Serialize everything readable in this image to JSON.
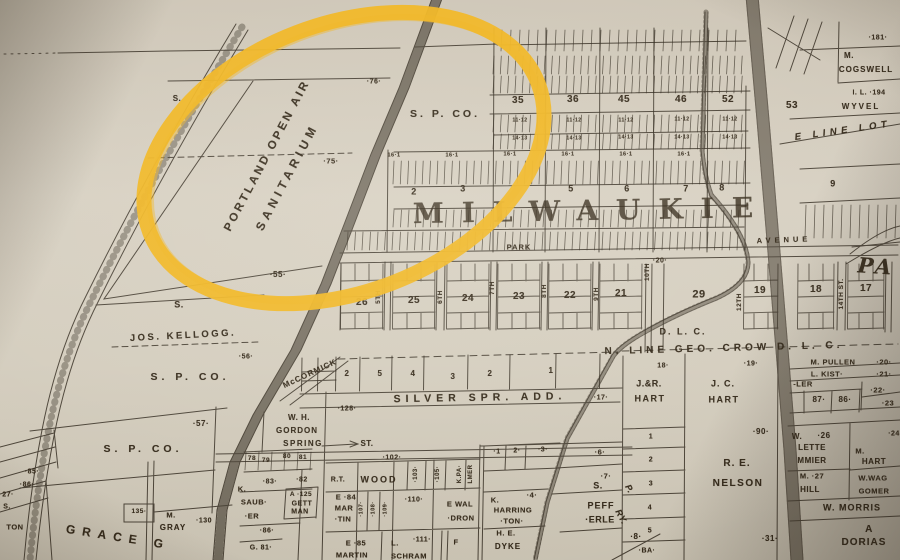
{
  "map": {
    "description": "Historic plat map of Milwaukie — Portland Open Air Sanitarium circled in yellow marker",
    "highlighted_place": "PORTLAND OPEN AIR SANITARIUM",
    "paper_color": "#d3ccbd",
    "ink_color": "#2b2318",
    "highlight_color": "#f0b41c"
  },
  "labels": [
    {
      "t": "PORTLAND OPEN AIR",
      "x": 268,
      "y": 156,
      "s": 11.5,
      "r": -62,
      "ls": 2.8,
      "n": "portland-open-air-label"
    },
    {
      "t": "SANITARIUM",
      "x": 287,
      "y": 177,
      "s": 12,
      "r": -62,
      "ls": 4.5,
      "n": "sanitarium-label"
    },
    {
      "t": "S. P. CO.",
      "x": 445,
      "y": 114,
      "s": 10.5,
      "ls": 3
    },
    {
      "t": "S. P. CO.",
      "x": 190,
      "y": 377,
      "s": 10.5,
      "ls": 4
    },
    {
      "t": "S. P. CO.",
      "x": 143,
      "y": 449,
      "s": 10.5,
      "ls": 4
    },
    {
      "t": "·76·",
      "x": 374,
      "y": 82,
      "s": 7
    },
    {
      "t": "·75·",
      "x": 331,
      "y": 161,
      "s": 7.5
    },
    {
      "t": "·55·",
      "x": 278,
      "y": 275,
      "s": 8
    },
    {
      "t": "·56·",
      "x": 246,
      "y": 357,
      "s": 7
    },
    {
      "t": "·57·",
      "x": 201,
      "y": 424,
      "s": 8
    },
    {
      "t": "JOS. KELLOGG.",
      "x": 183,
      "y": 336,
      "s": 9.5,
      "ls": 2.5,
      "r": -3
    },
    {
      "t": "S.",
      "x": 177,
      "y": 99,
      "s": 8
    },
    {
      "t": "S.",
      "x": 179,
      "y": 305,
      "s": 9
    },
    {
      "t": "MILWAUKIE",
      "x": 592,
      "y": 211,
      "s": 28,
      "ls": 18,
      "f": 1,
      "o": 0.82,
      "r": -1,
      "n": "milwaukie-label"
    },
    {
      "t": "PARK",
      "x": 519,
      "y": 247,
      "s": 7.5,
      "ls": 1
    },
    {
      "t": "AVENUE",
      "x": 784,
      "y": 240,
      "s": 7.5,
      "ls": 4,
      "r": -2
    },
    {
      "t": "PA",
      "x": 876,
      "y": 266,
      "s": 21,
      "f": 1,
      "i": 1,
      "r": 4,
      "ls": 3
    },
    {
      "t": "E LINE LOT",
      "x": 843,
      "y": 131,
      "s": 9.5,
      "i": 1,
      "ls": 4.5,
      "r": -8
    },
    {
      "t": "35",
      "x": 518,
      "y": 101,
      "s": 10
    },
    {
      "t": "36",
      "x": 573,
      "y": 100,
      "s": 10
    },
    {
      "t": "45",
      "x": 624,
      "y": 100,
      "s": 10
    },
    {
      "t": "46",
      "x": 681,
      "y": 100,
      "s": 10
    },
    {
      "t": "52",
      "x": 728,
      "y": 100,
      "s": 10
    },
    {
      "t": "53",
      "x": 792,
      "y": 106,
      "s": 10
    },
    {
      "t": "2",
      "x": 414,
      "y": 192,
      "s": 9
    },
    {
      "t": "3",
      "x": 463,
      "y": 189,
      "s": 9
    },
    {
      "t": "5",
      "x": 571,
      "y": 189,
      "s": 9
    },
    {
      "t": "6",
      "x": 627,
      "y": 189,
      "s": 9
    },
    {
      "t": "7",
      "x": 686,
      "y": 189,
      "s": 9
    },
    {
      "t": "8",
      "x": 722,
      "y": 188,
      "s": 9
    },
    {
      "t": "16·1",
      "x": 394,
      "y": 156,
      "s": 5.5
    },
    {
      "t": "16·1",
      "x": 452,
      "y": 156,
      "s": 5.5
    },
    {
      "t": "16·1",
      "x": 510,
      "y": 155,
      "s": 5.5
    },
    {
      "t": "16·1",
      "x": 568,
      "y": 155,
      "s": 5.5
    },
    {
      "t": "16·1",
      "x": 626,
      "y": 155,
      "s": 5.5
    },
    {
      "t": "16·1",
      "x": 684,
      "y": 155,
      "s": 5.5
    },
    {
      "t": "11·12",
      "x": 520,
      "y": 121,
      "s": 5
    },
    {
      "t": "11·12",
      "x": 574,
      "y": 121,
      "s": 5
    },
    {
      "t": "11·12",
      "x": 626,
      "y": 121,
      "s": 5
    },
    {
      "t": "11·12",
      "x": 682,
      "y": 120,
      "s": 5
    },
    {
      "t": "11·12",
      "x": 730,
      "y": 120,
      "s": 5
    },
    {
      "t": "14·13",
      "x": 520,
      "y": 139,
      "s": 5
    },
    {
      "t": "14·13",
      "x": 574,
      "y": 139,
      "s": 5
    },
    {
      "t": "14·13",
      "x": 626,
      "y": 138,
      "s": 5
    },
    {
      "t": "14·13",
      "x": 682,
      "y": 138,
      "s": 5
    },
    {
      "t": "14·13",
      "x": 730,
      "y": 138,
      "s": 5
    },
    {
      "t": "26",
      "x": 362,
      "y": 303,
      "s": 10
    },
    {
      "t": "25",
      "x": 414,
      "y": 301,
      "s": 10
    },
    {
      "t": "24",
      "x": 468,
      "y": 299,
      "s": 10
    },
    {
      "t": "23",
      "x": 519,
      "y": 297,
      "s": 10
    },
    {
      "t": "22",
      "x": 570,
      "y": 296,
      "s": 10
    },
    {
      "t": "21",
      "x": 621,
      "y": 294,
      "s": 10
    },
    {
      "t": "29",
      "x": 699,
      "y": 295,
      "s": 11
    },
    {
      "t": "19",
      "x": 760,
      "y": 291,
      "s": 10
    },
    {
      "t": "18",
      "x": 816,
      "y": 290,
      "s": 10
    },
    {
      "t": "17",
      "x": 866,
      "y": 289,
      "s": 10
    },
    {
      "t": "·20·",
      "x": 660,
      "y": 261,
      "s": 7
    },
    {
      "t": "5TH",
      "x": 379,
      "y": 297,
      "s": 6.5,
      "r": -90
    },
    {
      "t": "6TH",
      "x": 441,
      "y": 297,
      "s": 6.5,
      "r": -90
    },
    {
      "t": "7TH",
      "x": 493,
      "y": 288,
      "s": 6.5,
      "r": -90
    },
    {
      "t": "8TH",
      "x": 545,
      "y": 291,
      "s": 6.5,
      "r": -90
    },
    {
      "t": "9TH",
      "x": 597,
      "y": 294,
      "s": 6.5,
      "r": -90
    },
    {
      "t": "10TH",
      "x": 648,
      "y": 272,
      "s": 6.5,
      "r": -90
    },
    {
      "t": "12TH",
      "x": 740,
      "y": 302,
      "s": 6.5,
      "r": -90
    },
    {
      "t": "14TH ST.",
      "x": 842,
      "y": 294,
      "s": 6.5,
      "r": -90
    },
    {
      "t": "D. L. C.",
      "x": 683,
      "y": 332,
      "s": 9,
      "ls": 2
    },
    {
      "t": "N. LINE GEO. CROW D. L. C.",
      "x": 724,
      "y": 349,
      "s": 10,
      "ls": 4,
      "r": -1.5
    },
    {
      "t": "·181·",
      "x": 878,
      "y": 38,
      "s": 7
    },
    {
      "t": "M.",
      "x": 849,
      "y": 56,
      "s": 8
    },
    {
      "t": "COGSWELL",
      "x": 866,
      "y": 70,
      "s": 8,
      "ls": 1
    },
    {
      "t": "I. L. ·194",
      "x": 869,
      "y": 93,
      "s": 7
    },
    {
      "t": "WYVEL",
      "x": 861,
      "y": 107,
      "s": 8,
      "ls": 2
    },
    {
      "t": "9",
      "x": 833,
      "y": 184,
      "s": 9
    },
    {
      "t": "McCORMICK",
      "x": 310,
      "y": 374,
      "s": 8,
      "r": -25,
      "ls": 1
    },
    {
      "t": "2",
      "x": 347,
      "y": 374,
      "s": 8
    },
    {
      "t": "5",
      "x": 380,
      "y": 374,
      "s": 8
    },
    {
      "t": "4",
      "x": 413,
      "y": 374,
      "s": 8
    },
    {
      "t": "3",
      "x": 453,
      "y": 377,
      "s": 8
    },
    {
      "t": "2",
      "x": 490,
      "y": 374,
      "s": 8
    },
    {
      "t": "1",
      "x": 551,
      "y": 371,
      "s": 8
    },
    {
      "t": "SILVER SPR. ADD.",
      "x": 480,
      "y": 398,
      "s": 10.5,
      "ls": 5,
      "r": -1
    },
    {
      "t": "·17·",
      "x": 601,
      "y": 398,
      "s": 7
    },
    {
      "t": "·128·",
      "x": 347,
      "y": 409,
      "s": 7
    },
    {
      "t": "W. H.",
      "x": 299,
      "y": 418,
      "s": 8
    },
    {
      "t": "GORDON",
      "x": 297,
      "y": 431,
      "s": 8,
      "ls": 1
    },
    {
      "t": "SPRING",
      "x": 303,
      "y": 444,
      "s": 8,
      "ls": 1.5
    },
    {
      "t": "ST.",
      "x": 367,
      "y": 444,
      "s": 8
    },
    {
      "t": "78",
      "x": 252,
      "y": 459,
      "s": 6.5
    },
    {
      "t": "79",
      "x": 266,
      "y": 461,
      "s": 6.5
    },
    {
      "t": "80",
      "x": 287,
      "y": 457,
      "s": 6.5
    },
    {
      "t": "81",
      "x": 303,
      "y": 458,
      "s": 6.5
    },
    {
      "t": "·83·",
      "x": 270,
      "y": 482,
      "s": 7
    },
    {
      "t": "·82",
      "x": 302,
      "y": 480,
      "s": 7
    },
    {
      "t": "K.",
      "x": 242,
      "y": 489,
      "s": 7.5
    },
    {
      "t": "SAUB·",
      "x": 254,
      "y": 502,
      "s": 7.5
    },
    {
      "t": "·ER",
      "x": 252,
      "y": 516,
      "s": 7.5
    },
    {
      "t": "A ·125",
      "x": 301,
      "y": 495,
      "s": 6.5
    },
    {
      "t": "GETT",
      "x": 302,
      "y": 504,
      "s": 7
    },
    {
      "t": "MAN",
      "x": 300,
      "y": 512,
      "s": 7
    },
    {
      "t": "·86·",
      "x": 267,
      "y": 531,
      "s": 7
    },
    {
      "t": "G. 81·",
      "x": 261,
      "y": 548,
      "s": 7
    },
    {
      "t": "R.T.",
      "x": 338,
      "y": 480,
      "s": 7
    },
    {
      "t": "WOOD",
      "x": 379,
      "y": 480,
      "s": 9,
      "ls": 2
    },
    {
      "t": "·102·",
      "x": 392,
      "y": 458,
      "s": 7
    },
    {
      "t": "·103·",
      "x": 416,
      "y": 474,
      "s": 6,
      "r": -90
    },
    {
      "t": "·105·",
      "x": 438,
      "y": 474,
      "s": 6,
      "r": -90
    },
    {
      "t": "K.PA·",
      "x": 460,
      "y": 474,
      "s": 6,
      "r": -90
    },
    {
      "t": "LMER",
      "x": 471,
      "y": 474,
      "s": 6,
      "r": -90
    },
    {
      "t": "E ·84",
      "x": 346,
      "y": 497,
      "s": 7.5
    },
    {
      "t": "MAR",
      "x": 344,
      "y": 508,
      "s": 7.5
    },
    {
      "t": "·TIN",
      "x": 343,
      "y": 519,
      "s": 7.5
    },
    {
      "t": "·107·",
      "x": 362,
      "y": 509,
      "s": 5.5,
      "r": -90
    },
    {
      "t": "·108·",
      "x": 374,
      "y": 509,
      "s": 5.5,
      "r": -90
    },
    {
      "t": "·109·",
      "x": 386,
      "y": 509,
      "s": 5.5,
      "r": -90
    },
    {
      "t": "·110·",
      "x": 414,
      "y": 500,
      "s": 7
    },
    {
      "t": "E WAL",
      "x": 460,
      "y": 504,
      "s": 7.5
    },
    {
      "t": "·DRON",
      "x": 461,
      "y": 518,
      "s": 7.5
    },
    {
      "t": "E ·85",
      "x": 356,
      "y": 543,
      "s": 7.5
    },
    {
      "t": "MARTIN",
      "x": 352,
      "y": 555,
      "s": 7.5
    },
    {
      "t": "L.",
      "x": 395,
      "y": 543,
      "s": 7.5
    },
    {
      "t": "·111·",
      "x": 422,
      "y": 540,
      "s": 7
    },
    {
      "t": "SCHRAM",
      "x": 409,
      "y": 556,
      "s": 7.5
    },
    {
      "t": "F",
      "x": 456,
      "y": 542,
      "s": 7.5
    },
    {
      "t": "·1",
      "x": 497,
      "y": 452,
      "s": 7
    },
    {
      "t": "2·",
      "x": 517,
      "y": 451,
      "s": 7
    },
    {
      "t": "·3·",
      "x": 543,
      "y": 450,
      "s": 7
    },
    {
      "t": "K.",
      "x": 495,
      "y": 500,
      "s": 7.5
    },
    {
      "t": "HARRING",
      "x": 513,
      "y": 510,
      "s": 7.5
    },
    {
      "t": "·TON·",
      "x": 512,
      "y": 521,
      "s": 7.5
    },
    {
      "t": "·4·",
      "x": 532,
      "y": 495,
      "s": 7.5
    },
    {
      "t": "H. E.",
      "x": 506,
      "y": 533,
      "s": 7.5
    },
    {
      "t": "DYKE",
      "x": 508,
      "y": 547,
      "s": 8,
      "ls": 1
    },
    {
      "t": "·6·",
      "x": 600,
      "y": 452,
      "s": 7.5
    },
    {
      "t": "·7·",
      "x": 606,
      "y": 476,
      "s": 7.5
    },
    {
      "t": "S.",
      "x": 598,
      "y": 486,
      "s": 9
    },
    {
      "t": "PEFF",
      "x": 601,
      "y": 506,
      "s": 9,
      "ls": 1
    },
    {
      "t": "·ERLE",
      "x": 600,
      "y": 520,
      "s": 9
    },
    {
      "t": "·8·",
      "x": 636,
      "y": 537,
      "s": 8
    },
    {
      "t": "·BA·",
      "x": 647,
      "y": 551,
      "s": 7
    },
    {
      "t": "P.",
      "x": 629,
      "y": 489,
      "s": 9,
      "i": 1,
      "r": 62
    },
    {
      "t": "RY.",
      "x": 621,
      "y": 517,
      "s": 9,
      "i": 1,
      "r": 62
    },
    {
      "t": "18·",
      "x": 663,
      "y": 366,
      "s": 7
    },
    {
      "t": "·19·",
      "x": 751,
      "y": 364,
      "s": 7
    },
    {
      "t": "J.&R.",
      "x": 649,
      "y": 384,
      "s": 9
    },
    {
      "t": "HART",
      "x": 650,
      "y": 399,
      "s": 9,
      "ls": 1.5
    },
    {
      "t": "J. C.",
      "x": 723,
      "y": 384,
      "s": 9,
      "ls": 1
    },
    {
      "t": "HART",
      "x": 724,
      "y": 400,
      "s": 9,
      "ls": 1.5
    },
    {
      "t": "·90·",
      "x": 761,
      "y": 432,
      "s": 8
    },
    {
      "t": "R. E.",
      "x": 737,
      "y": 464,
      "s": 10,
      "ls": 1
    },
    {
      "t": "NELSON",
      "x": 738,
      "y": 484,
      "s": 10,
      "ls": 1.5
    },
    {
      "t": "·31·",
      "x": 770,
      "y": 539,
      "s": 8
    },
    {
      "t": "1",
      "x": 651,
      "y": 437,
      "s": 7
    },
    {
      "t": "2",
      "x": 651,
      "y": 460,
      "s": 7
    },
    {
      "t": "3",
      "x": 651,
      "y": 484,
      "s": 7
    },
    {
      "t": "4",
      "x": 650,
      "y": 508,
      "s": 7
    },
    {
      "t": "5",
      "x": 650,
      "y": 531,
      "s": 7
    },
    {
      "t": "M. PULLEN",
      "x": 833,
      "y": 362,
      "s": 7.5
    },
    {
      "t": "·20·",
      "x": 884,
      "y": 362,
      "s": 7.5
    },
    {
      "t": "L. KIST·",
      "x": 827,
      "y": 374,
      "s": 7.5
    },
    {
      "t": "·21·",
      "x": 884,
      "y": 374,
      "s": 7.5
    },
    {
      "t": "-LER",
      "x": 803,
      "y": 384,
      "s": 7.5
    },
    {
      "t": "87·",
      "x": 819,
      "y": 400,
      "s": 8
    },
    {
      "t": "86·",
      "x": 845,
      "y": 400,
      "s": 8
    },
    {
      "t": "·22·",
      "x": 878,
      "y": 390,
      "s": 7.5
    },
    {
      "t": "·23",
      "x": 888,
      "y": 403,
      "s": 7.5
    },
    {
      "t": "W.",
      "x": 797,
      "y": 437,
      "s": 8
    },
    {
      "t": "·26",
      "x": 824,
      "y": 436,
      "s": 8
    },
    {
      "t": "LETTE",
      "x": 812,
      "y": 448,
      "s": 8
    },
    {
      "t": "MMIER",
      "x": 812,
      "y": 461,
      "s": 8
    },
    {
      "t": "M.",
      "x": 860,
      "y": 451,
      "s": 7.5
    },
    {
      "t": "HART",
      "x": 874,
      "y": 462,
      "s": 8
    },
    {
      "t": "M. ·27",
      "x": 812,
      "y": 476,
      "s": 7.5
    },
    {
      "t": "HILL",
      "x": 810,
      "y": 490,
      "s": 8
    },
    {
      "t": "W.WAG",
      "x": 873,
      "y": 478,
      "s": 7.5
    },
    {
      "t": "GOMER",
      "x": 874,
      "y": 491,
      "s": 7.5
    },
    {
      "t": "·24",
      "x": 894,
      "y": 434,
      "s": 7
    },
    {
      "t": "W. MORRIS",
      "x": 852,
      "y": 508,
      "s": 9,
      "ls": 1
    },
    {
      "t": "A",
      "x": 869,
      "y": 530,
      "s": 10
    },
    {
      "t": "DORIAS",
      "x": 864,
      "y": 543,
      "s": 10,
      "ls": 1
    },
    {
      "t": "·85·",
      "x": 32,
      "y": 472,
      "s": 7
    },
    {
      "t": "·86·",
      "x": 27,
      "y": 485,
      "s": 7
    },
    {
      "t": "27·",
      "x": 8,
      "y": 495,
      "s": 7
    },
    {
      "t": "S.",
      "x": 7,
      "y": 507,
      "s": 7
    },
    {
      "t": "TON",
      "x": 15,
      "y": 527,
      "s": 7.5
    },
    {
      "t": "GRACE G",
      "x": 118,
      "y": 537,
      "s": 12,
      "ls": 7,
      "r": 9
    },
    {
      "t": "135·",
      "x": 139,
      "y": 512,
      "s": 6.5
    },
    {
      "t": "M.",
      "x": 171,
      "y": 515,
      "s": 7.5
    },
    {
      "t": "GRAY",
      "x": 173,
      "y": 528,
      "s": 8,
      "ls": 1
    },
    {
      "t": "·130",
      "x": 204,
      "y": 521,
      "s": 7
    }
  ]
}
